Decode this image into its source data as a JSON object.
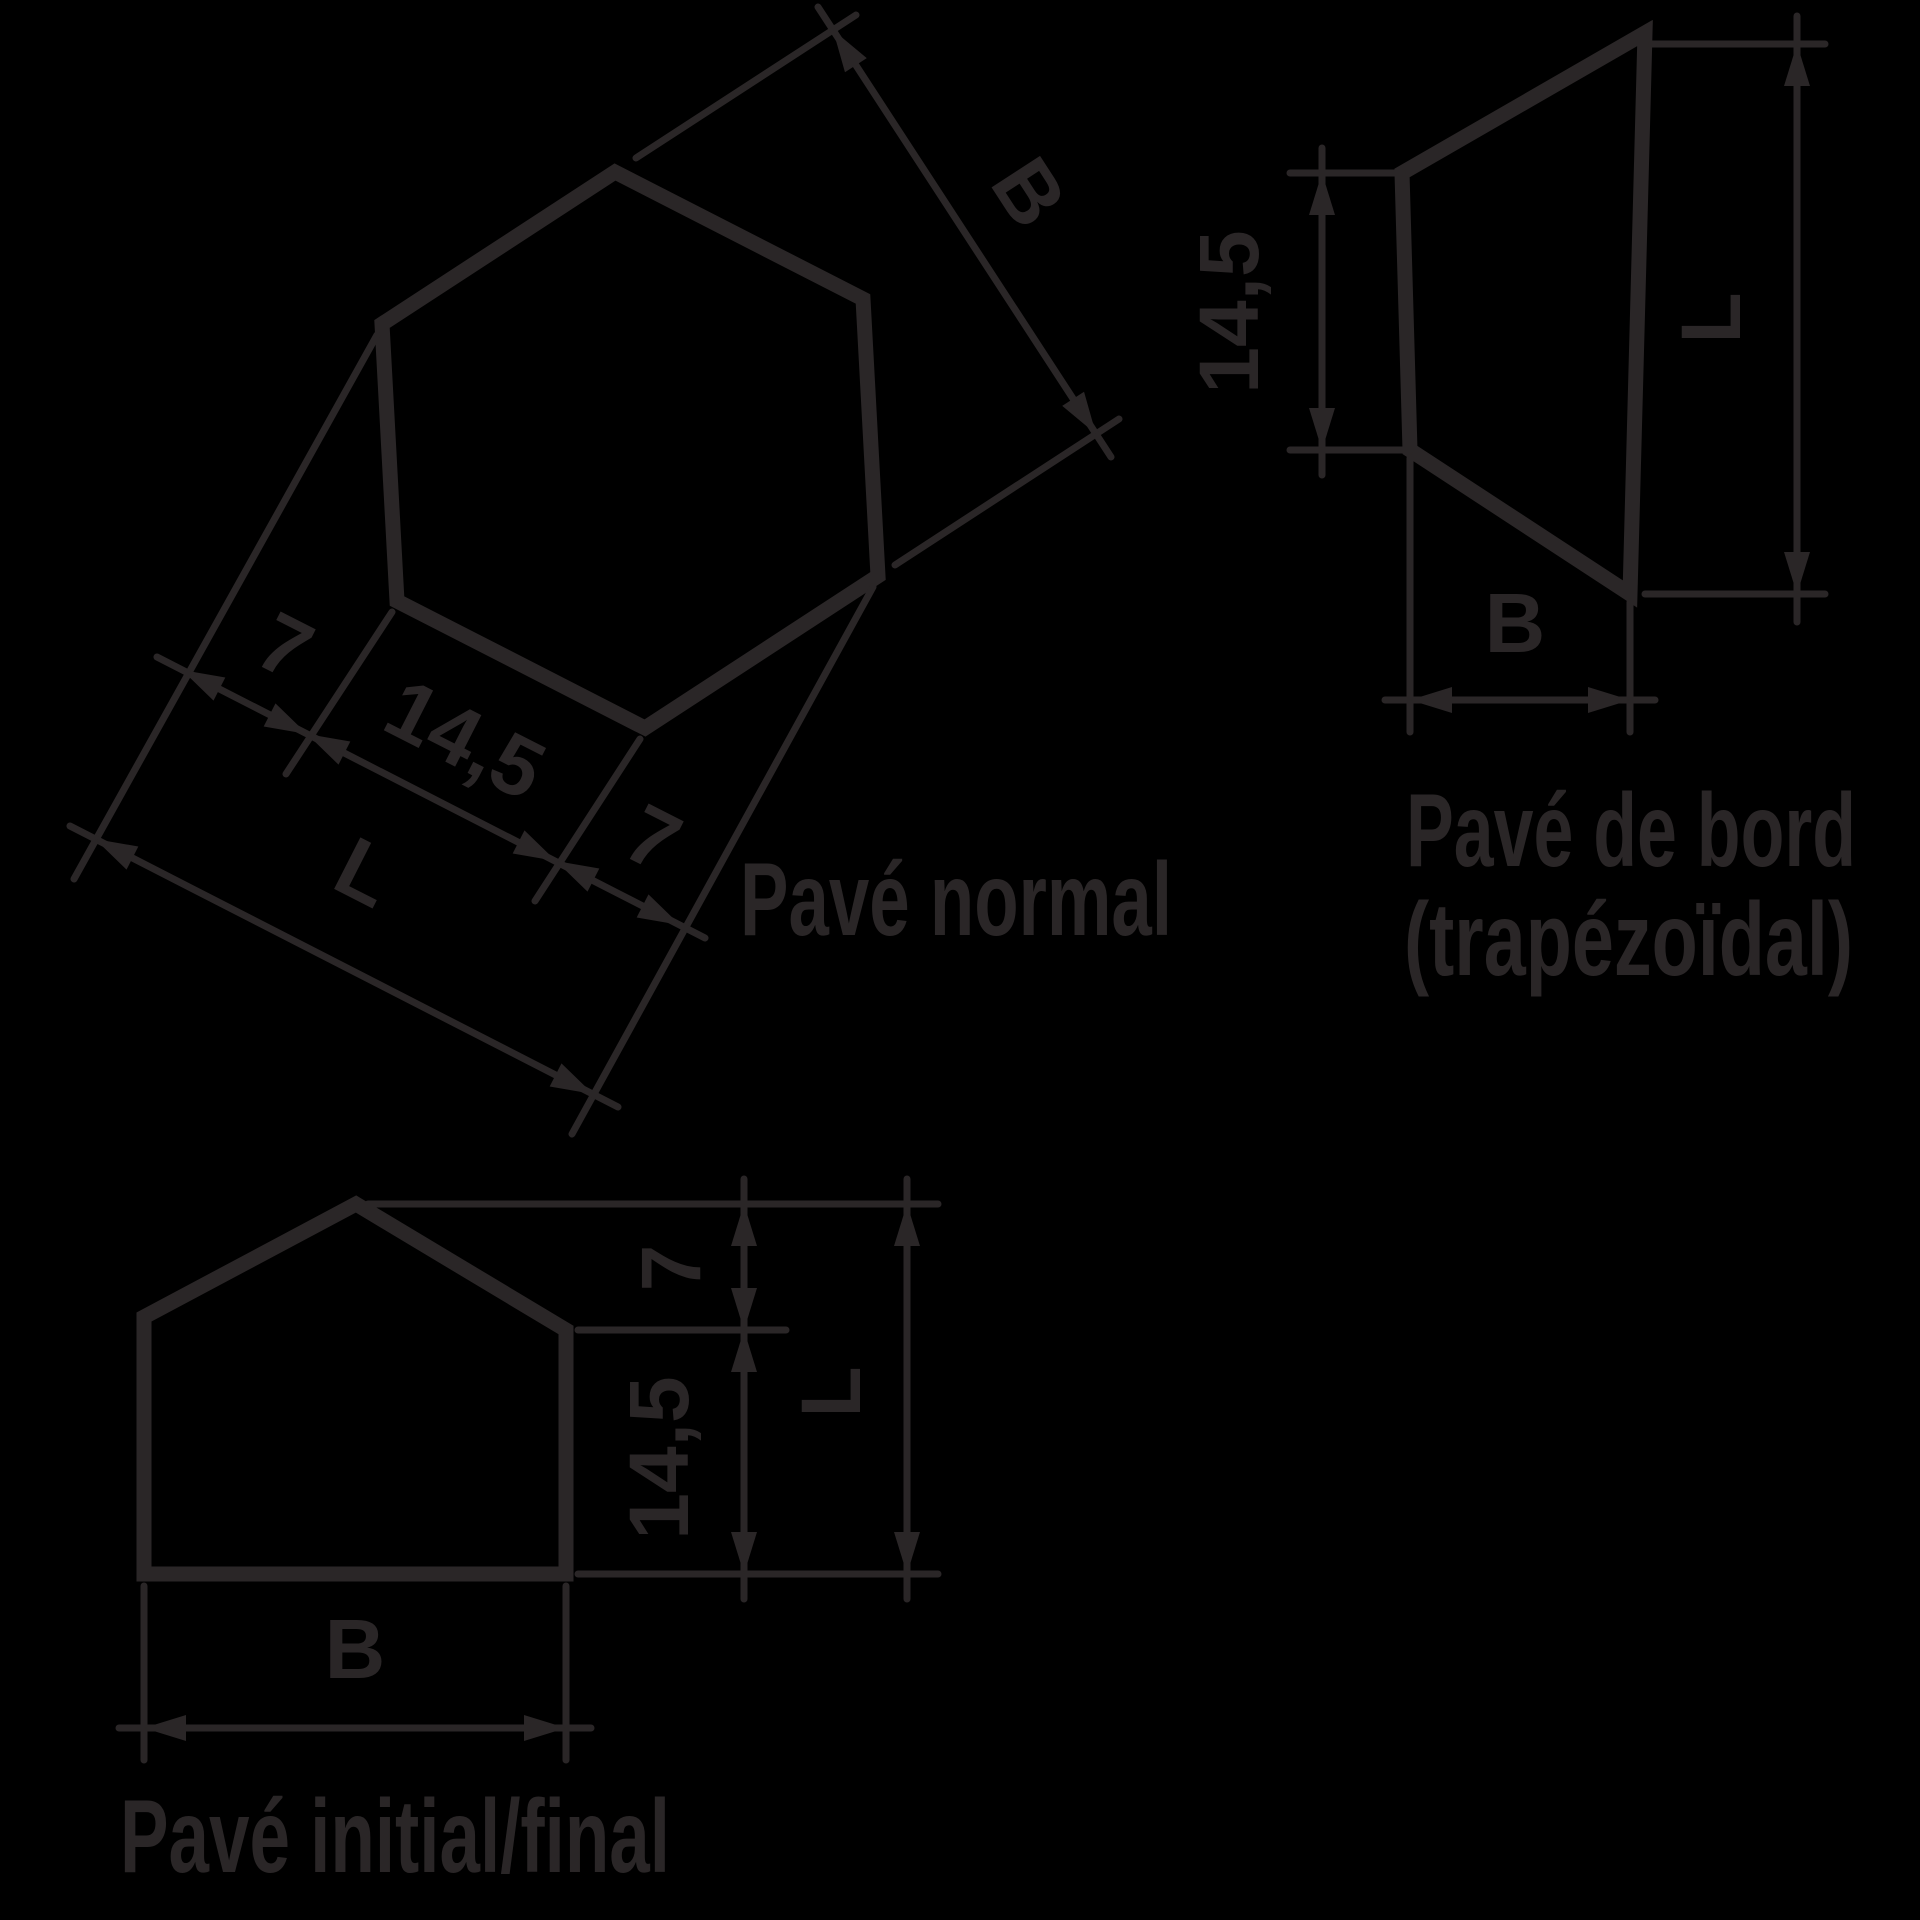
{
  "colors": {
    "ink": "#2a2627",
    "background": "#000000"
  },
  "diagrams": {
    "pave_normal": {
      "caption": "Pavé normal",
      "dims": {
        "b": "B",
        "seg1": "7",
        "seg2": "14,5",
        "seg3": "7",
        "total": "L"
      }
    },
    "pave_bord": {
      "caption_line1": "Pavé de bord",
      "caption_line2": "(trapézoïdal)",
      "dims": {
        "left": "14,5",
        "right": "L",
        "bottom": "B"
      }
    },
    "pave_initial": {
      "caption": "Pavé initial/final",
      "dims": {
        "seg1": "7",
        "seg2": "14,5",
        "total": "L",
        "bottom": "B"
      }
    }
  }
}
